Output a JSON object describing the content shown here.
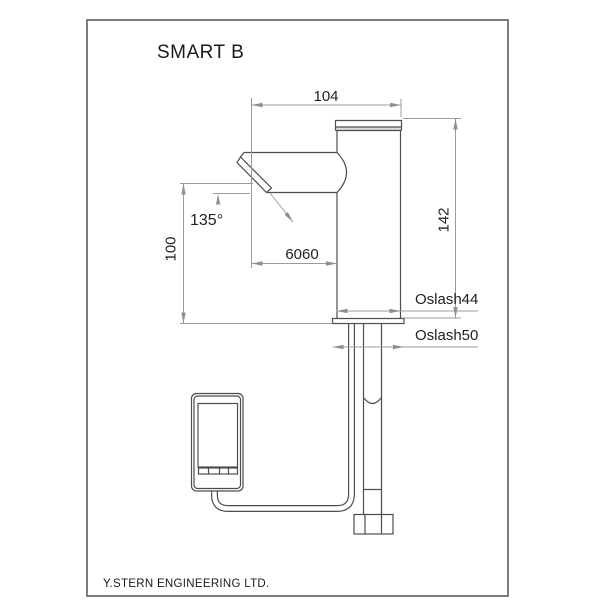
{
  "title": "SMART B",
  "footer": "Y.STERN ENGINEERING LTD.",
  "dimensions": {
    "reach": "104",
    "outlet_height": "100",
    "body_height": "142",
    "outlet_offset": "6060",
    "spray_angle": "135°",
    "body_diameter": "Oslash44",
    "base_diameter": "Oslash50"
  },
  "colors": {
    "background": "#ffffff",
    "frame": "#7d7d7d",
    "drawing_line": "#4d4d4d",
    "dimension_line": "#9b9b9b",
    "text": "#1f1f1f"
  }
}
